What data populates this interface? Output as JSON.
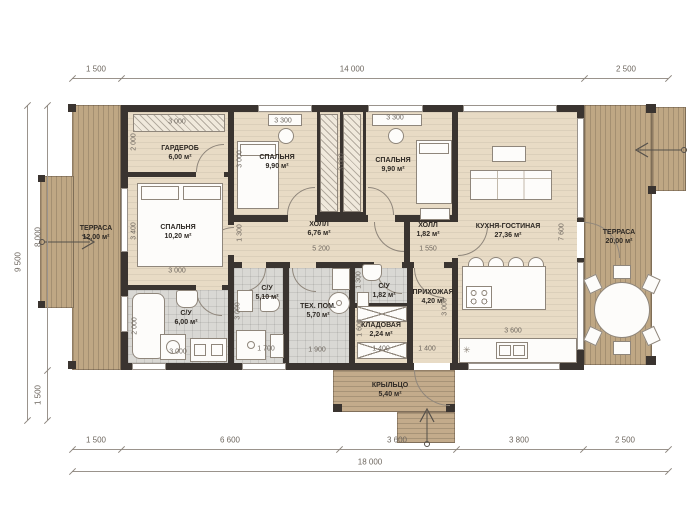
{
  "dims": {
    "top": [
      "1 500",
      "14 000",
      "2 500"
    ],
    "bottom": [
      "1 500",
      "6 600",
      "3 600",
      "3 800",
      "2 500"
    ],
    "bottom_total": "18 000",
    "left": [
      "8 000",
      "1 500"
    ],
    "left_total": "9 500"
  },
  "rooms": [
    {
      "name": "ТЕРРАСА",
      "area": "12,00 м²"
    },
    {
      "name": "ГАРДЕРОБ",
      "area": "6,00 м²"
    },
    {
      "name": "СПАЛЬНЯ",
      "area": "10,20 м²"
    },
    {
      "name": "С/У",
      "area": "6,00 м²"
    },
    {
      "name": "СПАЛЬНЯ",
      "area": "9,90 м²"
    },
    {
      "name": "СПАЛЬНЯ",
      "area": "9,90 м²"
    },
    {
      "name": "ХОЛЛ",
      "area": "6,76 м²"
    },
    {
      "name": "ХОЛЛ",
      "area": "1,82 м²"
    },
    {
      "name": "С/У",
      "area": "5,10 м²"
    },
    {
      "name": "ТЕХ. ПОМ.",
      "area": "5,70 м²"
    },
    {
      "name": "С/У",
      "area": "1,82 м²"
    },
    {
      "name": "КЛАДОВАЯ",
      "area": "2,24 м²"
    },
    {
      "name": "ПРИХОЖАЯ",
      "area": "4,20 м²"
    },
    {
      "name": "КУХНЯ-ГОСТИНАЯ",
      "area": "27,36 м²"
    },
    {
      "name": "ТЕРРАСА",
      "area": "20,00 м²"
    },
    {
      "name": "КРЫЛЬЦО",
      "area": "5,40 м²"
    }
  ],
  "idims": [
    "3 000",
    "2 000",
    "3 400",
    "3 000",
    "2 000",
    "3 000",
    "3 000",
    "3 300",
    "3 300",
    "3 000",
    "1 300",
    "5 200",
    "1 550",
    "3 000",
    "1 700",
    "1 900",
    "1 300",
    "1 600",
    "1 400",
    "1 400",
    "3 000",
    "3 600",
    "7 600"
  ],
  "icons": {
    "star": "✳",
    "entrance_left": "arrow-right",
    "entrance_right": "arrow-left",
    "entrance_porch": "arrow-up"
  }
}
